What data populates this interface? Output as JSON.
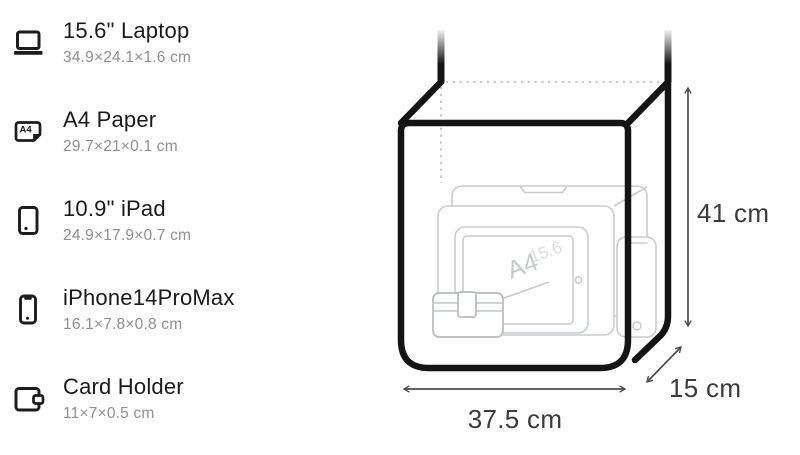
{
  "comparison_items": [
    {
      "title": "15.6\" Laptop",
      "dimensions": "34.9×24.1×1.6 cm",
      "icon": "laptop-icon"
    },
    {
      "title": "A4 Paper",
      "dimensions": "29.7×21×0.1 cm",
      "icon": "a4-paper-icon",
      "icon_text": "A4"
    },
    {
      "title": "10.9\" iPad",
      "dimensions": "24.9×17.9×0.7 cm",
      "icon": "tablet-icon"
    },
    {
      "title": "iPhone14ProMax",
      "dimensions": "16.1×7.8×0.8 cm",
      "icon": "phone-icon"
    },
    {
      "title": "Card Holder",
      "dimensions": "11×7×0.5 cm",
      "icon": "wallet-icon"
    }
  ],
  "diagram": {
    "height_label": "41 cm",
    "width_label": "37.5 cm",
    "depth_label": "15 cm",
    "sketch_paper_label": "A4",
    "sketch_laptop_label": "15.6",
    "colors": {
      "bag_outline": "#141414",
      "sketch_stroke": "#c9ccce",
      "dimension_text": "#3b3b3b",
      "arrow": "#4c4c4c",
      "title_text": "#1a1a1c",
      "subtitle_text": "#8e8e93"
    }
  }
}
